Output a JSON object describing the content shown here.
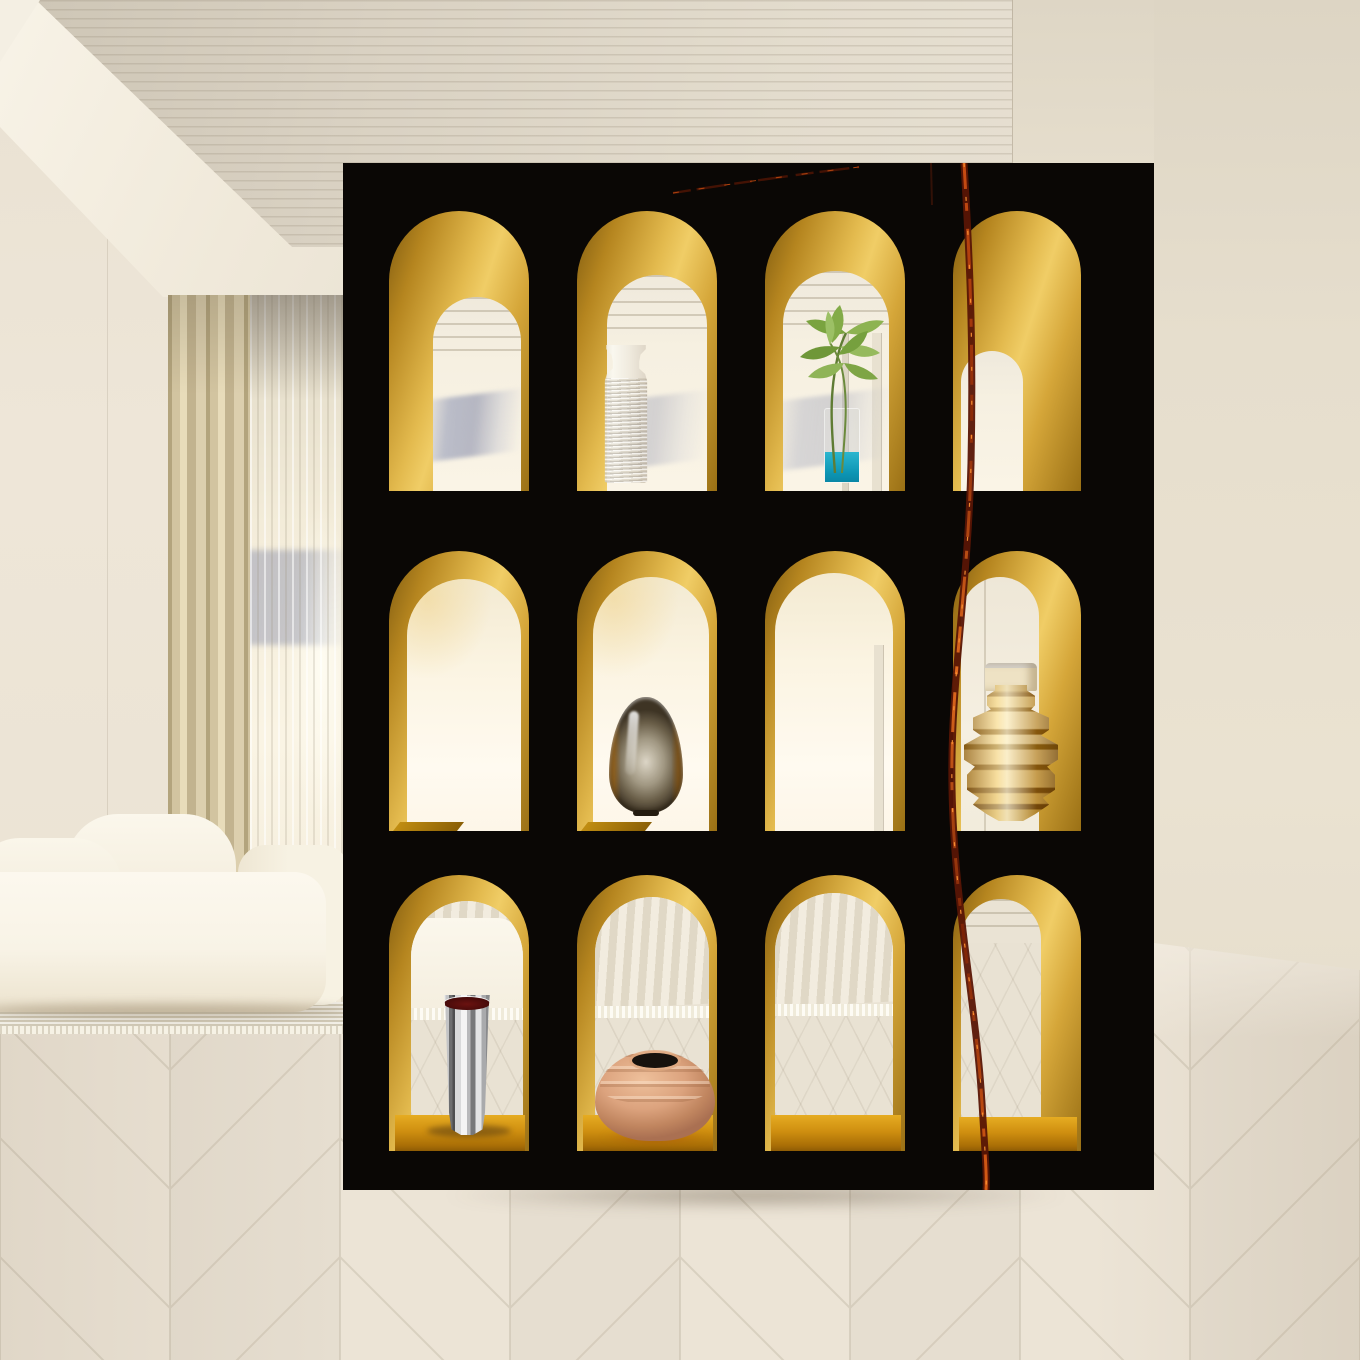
{
  "scene": {
    "type": "3D interior render",
    "description": "Minimalist beige living room with a freestanding black marble room-divider shelf of twelve gold arched niches displaying vases and a plant",
    "style": "warm minimalism"
  },
  "room": {
    "ceiling": {
      "finish": "wood-slat recessed tray with white cove trim",
      "slat_color": "#d9d1c2",
      "cove_color": "#f4efe2"
    },
    "walls": {
      "left_color": "#ece4d6",
      "right_color": "#e3dbca"
    },
    "floor": {
      "pattern": "herringbone parquet",
      "plank_light": "#ece4d6",
      "plank_dark": "#e6ded0",
      "seam_color": "#c9bfad"
    },
    "window": {
      "left_curtain": "champagne blackout drape",
      "right_curtain": "sheer voile",
      "glow_color": "#fdfaf0",
      "view_band_color": "#7a86a7"
    },
    "sofa": {
      "style": "low modular rounded sofa",
      "color": "#f8f4e8"
    },
    "rug": {
      "style": "ribbed rug with fringe",
      "color": "#e5dfce",
      "fringe_color": "#f6f2e5"
    }
  },
  "divider": {
    "finish": "black marble with copper vein",
    "face_color": "#0a0705",
    "vein_colors": [
      "#591505",
      "#c84c12",
      "#ff9736"
    ],
    "niche_finish": "polished brass arch niches",
    "gold_light": "#f0cd66",
    "gold_dark": "#8a6212",
    "shelf_color": "#cf8f10",
    "rows": 3,
    "columns": 4,
    "niche_count": 12
  },
  "objects": [
    {
      "name": "Ribbed clear glass vase",
      "material": "textured spun glass",
      "niche": "row 1, column 2",
      "colors": [
        "#f5f2e8",
        "#b9ae97"
      ]
    },
    {
      "name": "Green plant in glass cylinder with teal water",
      "material": "glass, water, foliage",
      "niche": "row 1, column 3",
      "colors": [
        "#86ac4c",
        "#17a6c2"
      ]
    },
    {
      "name": "Smoked glass teardrop vase",
      "material": "smoked amber glass",
      "niche": "row 2, column 2",
      "colors": [
        "#9b8d74",
        "#8a5c18"
      ]
    },
    {
      "name": "Brass tiered vase with pale lid",
      "material": "polished brass",
      "niche": "row 2, column 4",
      "colors": [
        "#f2d489",
        "#8d5f10",
        "#e8dcc0"
      ]
    },
    {
      "name": "Chrome cone vase with dark red mouth",
      "material": "mirror chrome",
      "niche": "row 3, column 1",
      "colors": [
        "#ededee",
        "#5e100e"
      ]
    },
    {
      "name": "Terracotta ribbed pot",
      "material": "clay",
      "niche": "row 3, column 2",
      "colors": [
        "#dca37e",
        "#17120d"
      ]
    }
  ],
  "empty_niches": [
    "row 1, column 1",
    "row 1, column 4",
    "row 2, column 1",
    "row 2, column 3",
    "row 3, column 3",
    "row 3, column 4"
  ]
}
